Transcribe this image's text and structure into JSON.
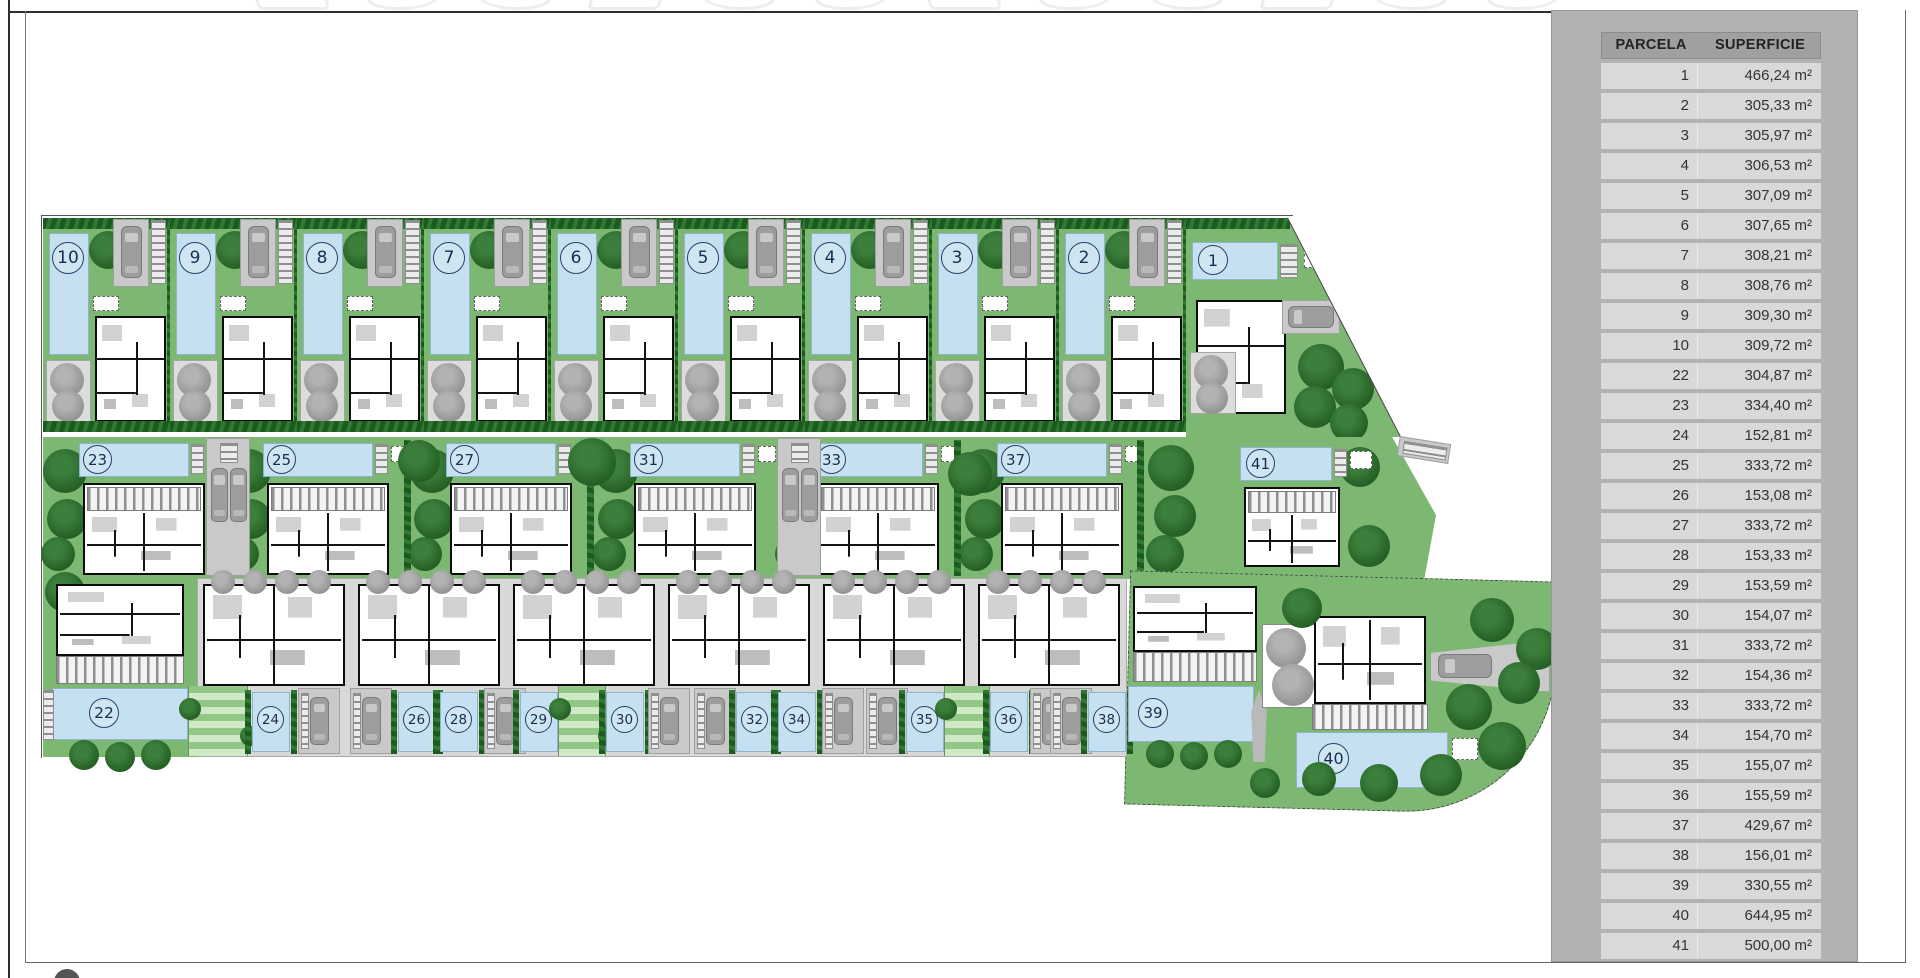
{
  "colors": {
    "garden_green": "#7db873",
    "garden_light": "#a9d29c",
    "pool_blue": "#c5e0f0",
    "hedge_green": "#1e5a1f",
    "tree_green": "#245f24",
    "paving_gray": "#d8d8d8",
    "car_gray": "#9d9d9d",
    "sidebar_bg": "#b2b2b2",
    "table_header_bg": "#a0a0a0",
    "table_row_bg": "#d9d9d9",
    "marker_ink": "#1c2c50"
  },
  "legend_table": {
    "headers": [
      "PARCELA",
      "SUPERFICIE"
    ],
    "rows": [
      [
        "1",
        "466,24 m²"
      ],
      [
        "2",
        "305,33 m²"
      ],
      [
        "3",
        "305,97 m²"
      ],
      [
        "4",
        "306,53 m²"
      ],
      [
        "5",
        "307,09 m²"
      ],
      [
        "6",
        "307,65 m²"
      ],
      [
        "7",
        "308,21 m²"
      ],
      [
        "8",
        "308,76 m²"
      ],
      [
        "9",
        "309,30 m²"
      ],
      [
        "10",
        "309,72 m²"
      ],
      [
        "22",
        "304,87 m²"
      ],
      [
        "23",
        "334,40 m²"
      ],
      [
        "24",
        "152,81 m²"
      ],
      [
        "25",
        "333,72 m²"
      ],
      [
        "26",
        "153,08 m²"
      ],
      [
        "27",
        "333,72 m²"
      ],
      [
        "28",
        "153,33 m²"
      ],
      [
        "29",
        "153,59 m²"
      ],
      [
        "30",
        "154,07 m²"
      ],
      [
        "31",
        "333,72 m²"
      ],
      [
        "32",
        "154,36 m²"
      ],
      [
        "33",
        "333,72 m²"
      ],
      [
        "34",
        "154,70 m²"
      ],
      [
        "35",
        "155,07 m²"
      ],
      [
        "36",
        "155,59 m²"
      ],
      [
        "37",
        "429,67 m²"
      ],
      [
        "38",
        "156,01 m²"
      ],
      [
        "39",
        "330,55 m²"
      ],
      [
        "40",
        "644,95 m²"
      ],
      [
        "41",
        "500,00 m²"
      ]
    ]
  },
  "plan": {
    "rows": {
      "top": [
        "10",
        "9",
        "8",
        "7",
        "6",
        "5",
        "4",
        "3",
        "2",
        "1"
      ],
      "middle": [
        "23",
        "25",
        "27",
        "31",
        "33",
        "37",
        "41"
      ],
      "bottom": [
        "22",
        "24",
        "26",
        "28",
        "29",
        "30",
        "32",
        "34",
        "35",
        "36",
        "38",
        "39",
        "40"
      ]
    }
  }
}
